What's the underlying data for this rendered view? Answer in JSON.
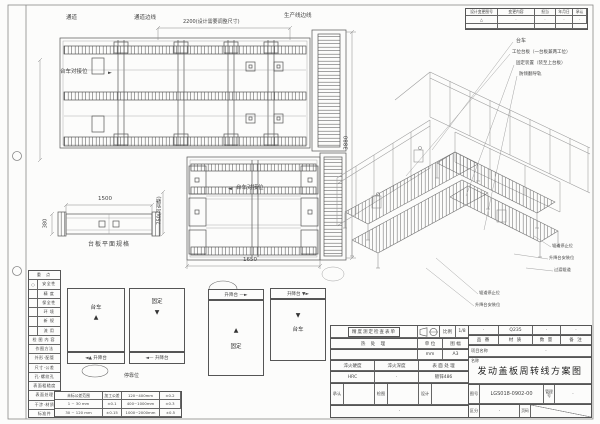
{
  "revision_table": {
    "headers": [
      "设计变更图号",
      "变更内容",
      "担当",
      "年月日",
      "承认"
    ],
    "row": [
      "△",
      "·",
      "·",
      "·",
      "·"
    ]
  },
  "plan_top": {
    "aisle": "通道",
    "aisle_line": "通道边线",
    "dim_width": "2200(设计需要调整尺寸)",
    "production_line": "生产线边线",
    "docking": "台车对接位",
    "docking_arrow": "►",
    "dim_height": "3880"
  },
  "plan_bottom": {
    "docking": "台车对接位",
    "docking_arrow": "◄",
    "dim_width": "1650"
  },
  "side_view": {
    "dim_length": "1500",
    "dim_width": "380",
    "dim_height": "750(可调整)",
    "caption": "台板平面规格"
  },
  "iso": {
    "callouts_top": [
      "台车",
      "工位台板（一台板兼两工位）",
      "固定装置（装至上台板）",
      "防倾翻导轨"
    ],
    "callouts_right": [
      "辊道停止位",
      "升降台安装位",
      "过渡辊道"
    ],
    "callouts_left": [
      "辊道停止位",
      "升降台安装位"
    ]
  },
  "checklist": {
    "section1_title": "重 点",
    "section1": [
      {
        "mark": "○",
        "label": "安全性"
      },
      {
        "mark": "",
        "label": "精 度"
      },
      {
        "mark": "",
        "label": "保全性"
      },
      {
        "mark": "",
        "label": "环 境"
      },
      {
        "mark": "",
        "label": "新 规"
      },
      {
        "mark": "",
        "label": "流 用"
      }
    ],
    "section2_title": "检图内容",
    "section2": [
      "作图方法",
      "外形·配管",
      "尺寸·公差",
      "孔·螺纹孔",
      "表面粗糙度",
      "表面处理",
      "干涉·材质",
      "标准件"
    ]
  },
  "tolerance": {
    "rows": [
      [
        "未标公差范围",
        "加工公差",
        "120~400mm",
        "±0.2"
      ],
      [
        "1 ~ 30 mm",
        "±0.1",
        "400~1000mm",
        "±0.3"
      ],
      [
        "30 ~ 120 mm",
        "±0.15",
        "1000~2000mm",
        "±0.5"
      ]
    ]
  },
  "states": {
    "trolley": "台车",
    "fixed": "固定",
    "up": "▲",
    "down": "▼",
    "lift_left_up": "◄▲ 升降台",
    "lift_left": "◄— 升降台",
    "lift_right": "升降台 —►",
    "lift_right_down": "升降台 ▼►",
    "caption": "停靠位"
  },
  "title_block": {
    "check_sheet": "精度测定检查表单",
    "scale_label": "比例",
    "scale_value": "1/8",
    "heat_label": "热 处 理",
    "unit_label": "单 位",
    "unit_value": "mm",
    "format_label": "图 幅",
    "format_value": "A3",
    "quench_hard_label": "淬火硬度",
    "quench_hard_value": "HRC",
    "quench_depth_label": "淬火深度",
    "quench_depth_value": "·",
    "surface_label": "表 面 处 理",
    "surface_value": "镀锌486",
    "part_no_label": "品 番",
    "part_no_value": "·",
    "material_label": "材 质",
    "material_value": "Q235",
    "qty_label": "数 量",
    "qty_value": "·",
    "remark_label": "备 注",
    "remark_value": "·",
    "project_label": "项目名称",
    "project_value": "·",
    "name_label": "名称",
    "drawing_name": "发动盖板周转线方案图",
    "approve_label": "承认",
    "check_label": "检图",
    "design_label": "设计",
    "sign_row_value": "·",
    "drawing_no_label": "图号",
    "drawing_no": "LGS018-0902-00",
    "manage_no_label": "管理号",
    "manage_no_value": "·",
    "class_label": "区分",
    "class_value": "·",
    "page_label": "页码"
  }
}
